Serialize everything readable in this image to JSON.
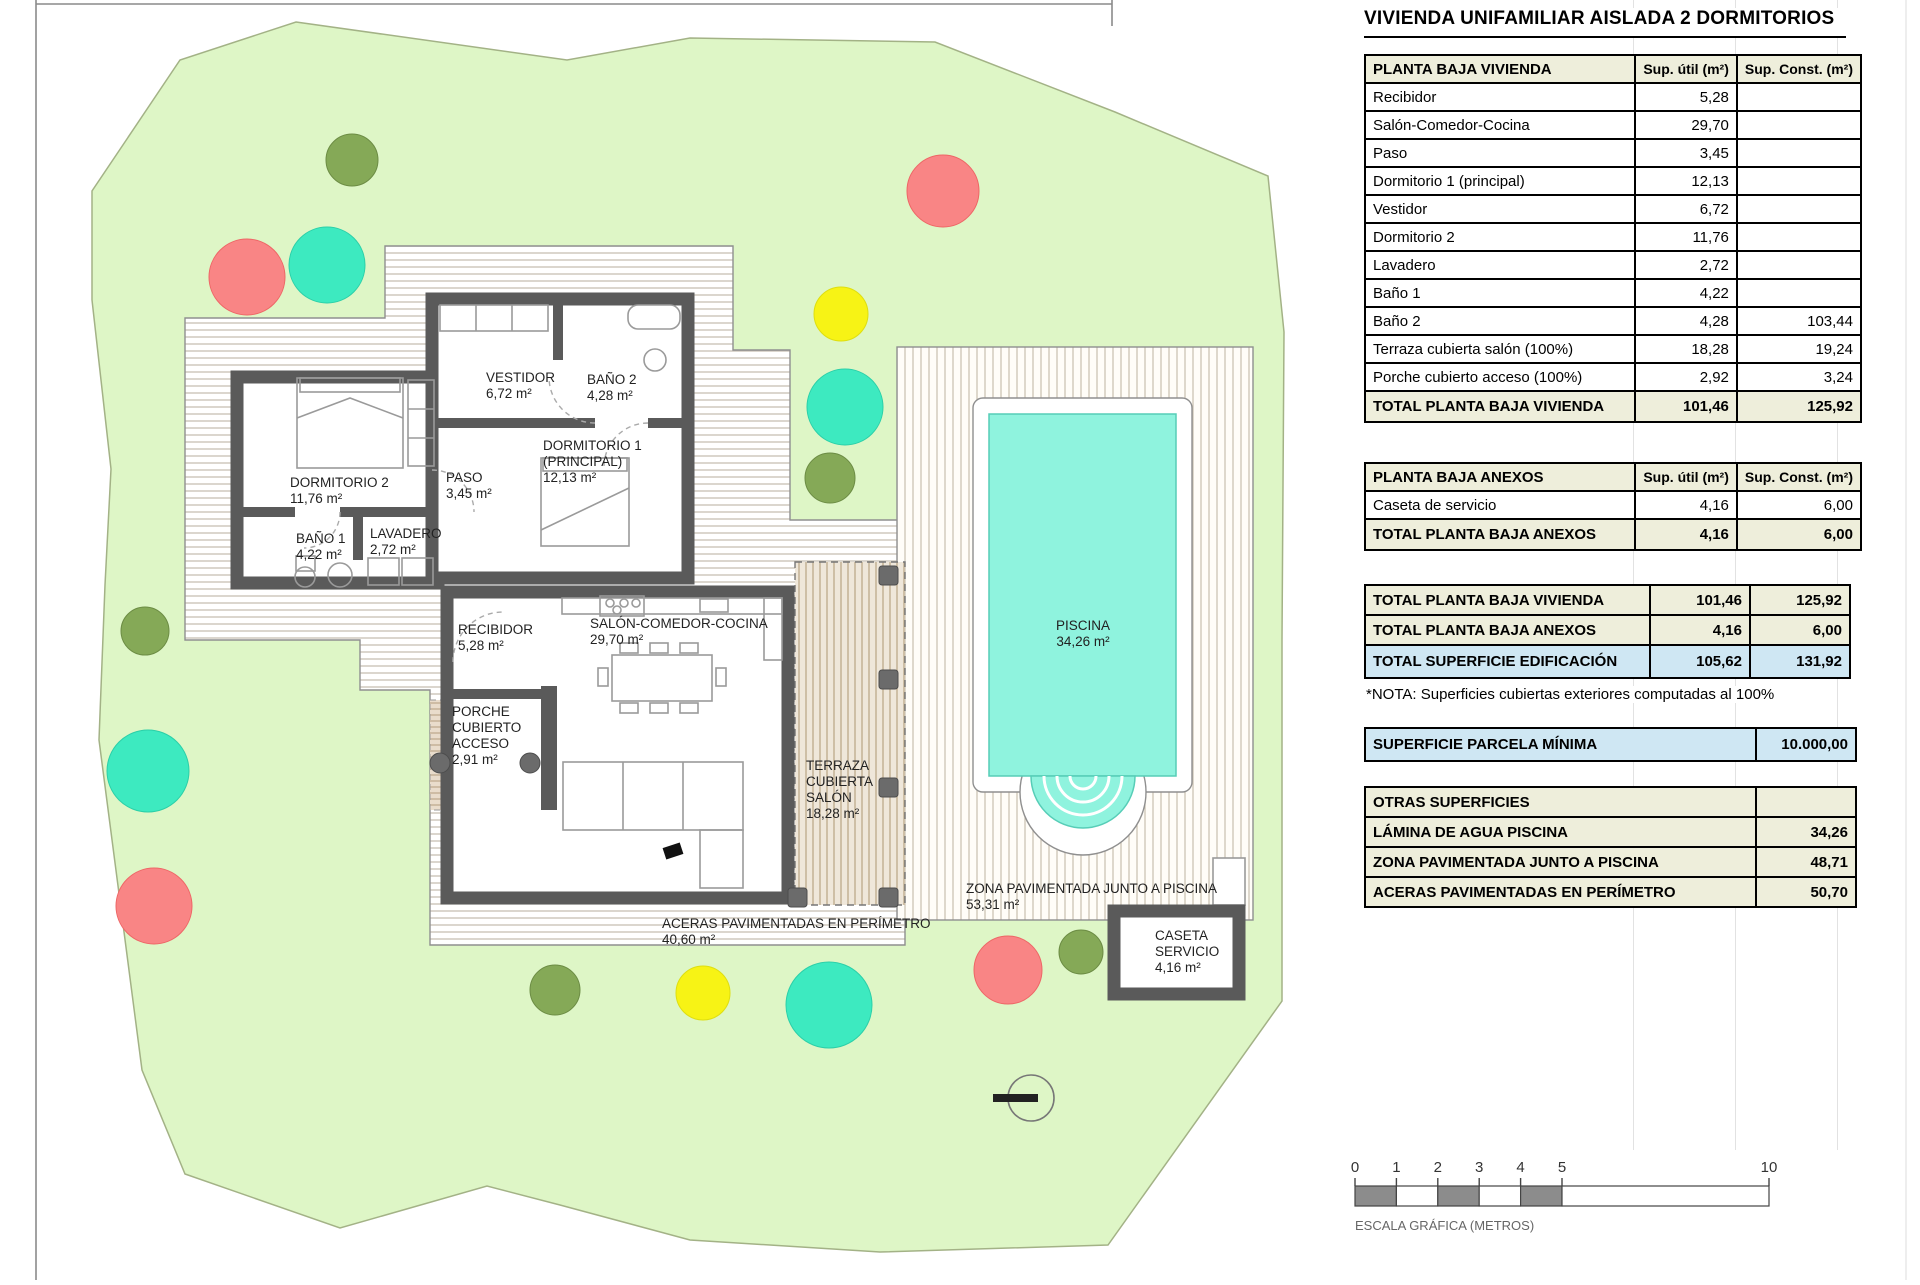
{
  "title": "VIVIENDA UNIFAMILIAR AISLADA 2 DORMITORIOS",
  "columns": {
    "util": "Sup. útil\n(m²)",
    "const": "Sup. Const.\n(m²)"
  },
  "tables": {
    "vivienda": {
      "header": "PLANTA BAJA VIVIENDA",
      "rows": [
        {
          "label": "Recibidor",
          "util": "5,28",
          "const": ""
        },
        {
          "label": "Salón-Comedor-Cocina",
          "util": "29,70",
          "const": ""
        },
        {
          "label": "Paso",
          "util": "3,45",
          "const": ""
        },
        {
          "label": "Dormitorio 1 (principal)",
          "util": "12,13",
          "const": ""
        },
        {
          "label": "Vestidor",
          "util": "6,72",
          "const": ""
        },
        {
          "label": "Dormitorio 2",
          "util": "11,76",
          "const": ""
        },
        {
          "label": "Lavadero",
          "util": "2,72",
          "const": ""
        },
        {
          "label": "Baño 1",
          "util": "4,22",
          "const": ""
        },
        {
          "label": "Baño 2",
          "util": "4,28",
          "const": "103,44"
        },
        {
          "label": "Terraza cubierta salón (100%)",
          "util": "18,28",
          "const": "19,24"
        },
        {
          "label": "Porche cubierto acceso (100%)",
          "util": "2,92",
          "const": "3,24"
        }
      ],
      "total": {
        "label": "TOTAL PLANTA BAJA VIVIENDA",
        "util": "101,46",
        "const": "125,92"
      }
    },
    "anexos": {
      "header": "PLANTA BAJA ANEXOS",
      "rows": [
        {
          "label": "Caseta de servicio",
          "util": "4,16",
          "const": "6,00"
        }
      ],
      "total": {
        "label": "TOTAL PLANTA BAJA ANEXOS",
        "util": "4,16",
        "const": "6,00"
      }
    },
    "resumen": [
      {
        "label": "TOTAL PLANTA BAJA VIVIENDA",
        "util": "101,46",
        "const": "125,92",
        "style": "beige"
      },
      {
        "label": "TOTAL PLANTA BAJA ANEXOS",
        "util": "4,16",
        "const": "6,00",
        "style": "beige"
      },
      {
        "label": "TOTAL SUPERFICIE EDIFICACIÓN",
        "util": "105,62",
        "const": "131,92",
        "style": "blue"
      }
    ],
    "nota": "*NOTA: Superficies cubiertas exteriores computadas al 100%",
    "parcela": {
      "label": "SUPERFICIE PARCELA MÍNIMA",
      "value": "10.000,00"
    },
    "otras": {
      "header": "OTRAS SUPERFICIES",
      "rows": [
        {
          "label": "LÁMINA DE AGUA PISCINA",
          "value": "34,26"
        },
        {
          "label": "ZONA PAVIMENTADA JUNTO A PISCINA",
          "value": "48,71"
        },
        {
          "label": "ACERAS PAVIMENTADAS EN PERÍMETRO",
          "value": "50,70"
        }
      ]
    }
  },
  "plan": {
    "labels": {
      "dorm2": [
        "DORMITORIO 2",
        "11,76 m²"
      ],
      "paso": [
        "PASO",
        "3,45 m²"
      ],
      "bano1": [
        "BAÑO 1",
        "4,22 m²"
      ],
      "lavadero": [
        "LAVADERO",
        "2,72 m²"
      ],
      "vestidor": [
        "VESTIDOR",
        "6,72 m²"
      ],
      "bano2": [
        "BAÑO 2",
        "4,28 m²"
      ],
      "dorm1": [
        "DORMITORIO 1",
        "(PRINCIPAL)",
        "12,13 m²"
      ],
      "recibidor": [
        "RECIBIDOR",
        "5,28 m²"
      ],
      "salon": [
        "SALÓN-COMEDOR-COCINA",
        "29,70 m²"
      ],
      "porche": [
        "PORCHE",
        "CUBIERTO",
        "ACCESO",
        "2,91 m²"
      ],
      "terraza": [
        "TERRAZA",
        "CUBIERTA",
        "SALÓN",
        "18,28 m²"
      ],
      "piscina": [
        "PISCINA",
        "34,26 m²"
      ],
      "zona": [
        "ZONA PAVIMENTADA JUNTO A PISCINA",
        "53,31 m²"
      ],
      "caseta": [
        "CASETA",
        "SERVICIO",
        "4,16 m²"
      ],
      "aceras": [
        "ACERAS PAVIMENTADAS EN PERÍMETRO",
        "40,60 m²"
      ]
    }
  },
  "scale": {
    "ticks": [
      "0",
      "1",
      "2",
      "3",
      "4",
      "5",
      "10"
    ],
    "caption": "ESCALA GRÁFICA (METROS)"
  },
  "colors": {
    "accent_blue": "#cfe7f3",
    "header_beige": "#eeeedb",
    "parcel_green": "#def6c6",
    "pool_aqua": "#8ff3de",
    "tree_olive": "#85a957",
    "tree_salmon": "#f98585",
    "tree_teal": "#3deac0",
    "tree_yellow": "#f7f315",
    "wall_gray": "#5a5a5a"
  }
}
